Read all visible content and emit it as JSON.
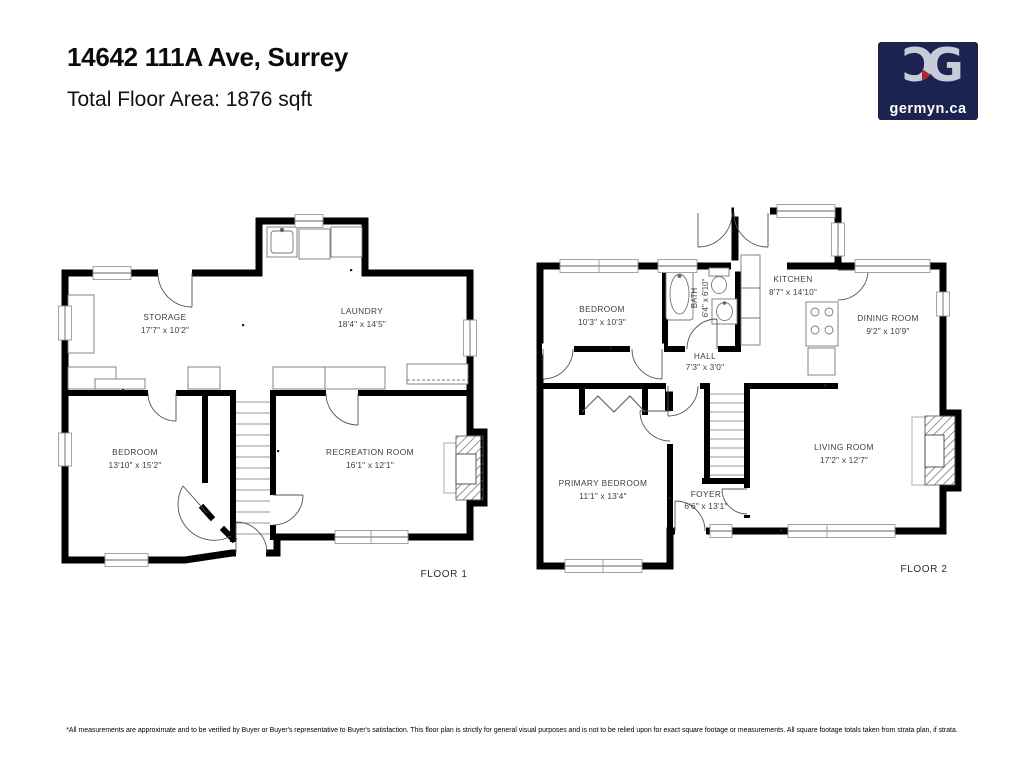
{
  "header": {
    "address": "14642 111A Ave, Surrey",
    "total_area": "Total Floor Area:  1876 sqft"
  },
  "logo": {
    "monogram_left": "Ɔ",
    "monogram_right": "G",
    "domain": "germyn.ca",
    "bg_color": "#1b2350",
    "letter_color": "#c7ccd9",
    "accent_color": "#ae2531"
  },
  "floor1": {
    "label": "FLOOR 1",
    "rooms": {
      "storage": {
        "name": "STORAGE",
        "dims": "17'7\" x 10'2\""
      },
      "laundry": {
        "name": "LAUNDRY",
        "dims": "18'4\" x 14'5\""
      },
      "bedroom": {
        "name": "BEDROOM",
        "dims": "13'10\" x 15'2\""
      },
      "recreation": {
        "name": "RECREATION ROOM",
        "dims": "16'1\" x 12'1\""
      }
    }
  },
  "floor2": {
    "label": "FLOOR 2",
    "rooms": {
      "bedroom": {
        "name": "BEDROOM",
        "dims": "10'3\" x 10'3\""
      },
      "bath": {
        "name": "BATH",
        "dims": "6'4\" x 6'10\""
      },
      "kitchen": {
        "name": "KITCHEN",
        "dims": "8'7\" x 14'10\""
      },
      "dining": {
        "name": "DINING ROOM",
        "dims": "9'2\" x 10'9\""
      },
      "hall": {
        "name": "HALL",
        "dims": "7'3\" x 3'0\""
      },
      "primary": {
        "name": "PRIMARY BEDROOM",
        "dims": "11'1\" x 13'4\""
      },
      "foyer": {
        "name": "FOYER",
        "dims": "6'6\" x 13'1\""
      },
      "living": {
        "name": "LIVING ROOM",
        "dims": "17'2\" x 12'7\""
      }
    }
  },
  "footer": {
    "disclaimer": "*All measurements are approximate and to be verified by Buyer or Buyer's representative to Buyer's satisfaction. This floor plan is strictly for general visual purposes and is not to be relied upon for exact square footage or measurements. All square footage totals taken from strata plan, if strata."
  },
  "colors": {
    "walls": "#000000",
    "room_label": "#3e3e3e"
  }
}
